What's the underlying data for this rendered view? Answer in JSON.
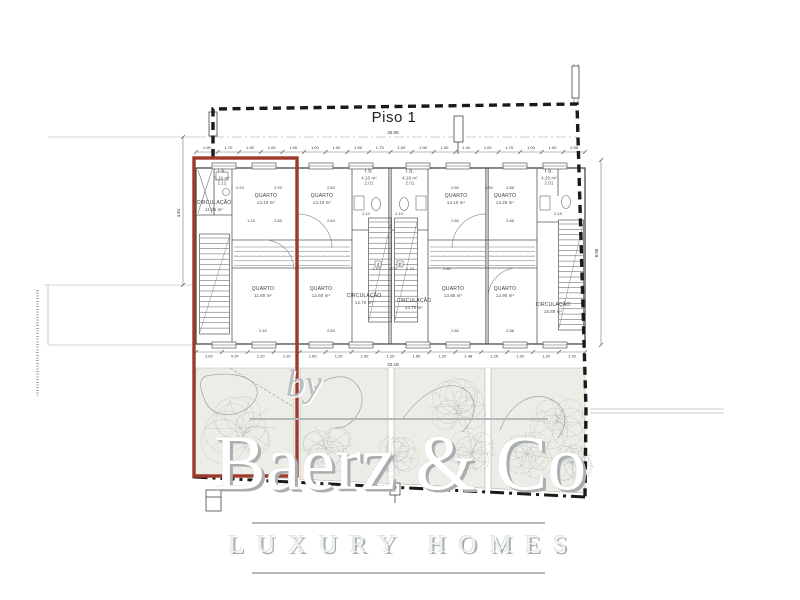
{
  "title": "Piso 1",
  "watermark": {
    "prefix": "by",
    "brand": "Baerz & Co",
    "tagline": "LUXURY HOMES"
  },
  "colors": {
    "highlight_red": "#9e3a2b",
    "boundary_black": "#1a1a1a",
    "plan_line": "#555555",
    "garden_fill": "#ecede6",
    "tree_gray": "#8f9797",
    "watermark_gray": "#b3b8b8"
  },
  "rooms": [
    {
      "label": "I.S.",
      "area": "3.10 m²",
      "sub": "2.12",
      "x": 222,
      "y": 177
    },
    {
      "label": "CIRCULAÇÃO",
      "area": "11.05 m²",
      "x": 214,
      "y": 206
    },
    {
      "label": "QUARTO",
      "area": "13.10 m²",
      "x": 266,
      "y": 199
    },
    {
      "label": "QUARTO",
      "area": "11.80 m²",
      "x": 263,
      "y": 292
    },
    {
      "label": "QUARTO",
      "area": "13.10 m²",
      "x": 322,
      "y": 199
    },
    {
      "label": "I.S.",
      "area": "4.20 m²",
      "sub": "2.01",
      "x": 369,
      "y": 177
    },
    {
      "label": "QUARTO",
      "area": "12.60 m²",
      "x": 321,
      "y": 292
    },
    {
      "label": "CIRCULAÇÃO",
      "area": "14.70 m²",
      "x": 364,
      "y": 299
    },
    {
      "label": "I.S.",
      "area": "4.20 m²",
      "sub": "2.01",
      "x": 410,
      "y": 177
    },
    {
      "label": "QUARTO",
      "area": "13.10 m²",
      "x": 456,
      "y": 199
    },
    {
      "label": "CIRCULAÇÃO",
      "area": "14.70 m²",
      "x": 414,
      "y": 304
    },
    {
      "label": "QUARTO",
      "area": "13.85 m²",
      "x": 453,
      "y": 292
    },
    {
      "label": "QUARTO",
      "area": "13.25 m²",
      "x": 505,
      "y": 199
    },
    {
      "label": "I.S.",
      "area": "4.20 m²",
      "sub": "2.01",
      "x": 549,
      "y": 177
    },
    {
      "label": "QUARTO",
      "area": "12.95 m²",
      "x": 505,
      "y": 292
    },
    {
      "label": "CIRCULAÇÃO",
      "area": "15.80 m²",
      "x": 553,
      "y": 308
    }
  ],
  "plan_dims": [
    {
      "t": "2.93",
      "x": 278,
      "y": 189
    },
    {
      "t": "2.83",
      "x": 278,
      "y": 222
    },
    {
      "t": "0.24",
      "x": 240,
      "y": 189
    },
    {
      "t": "1.15",
      "x": 251,
      "y": 222
    },
    {
      "t": "2.84",
      "x": 331,
      "y": 189
    },
    {
      "t": "2.84",
      "x": 331,
      "y": 222
    },
    {
      "t": "2.10",
      "x": 366,
      "y": 215
    },
    {
      "t": "2.10",
      "x": 399,
      "y": 215
    },
    {
      "t": "2.80",
      "x": 455,
      "y": 189
    },
    {
      "t": "2.80",
      "x": 455,
      "y": 222
    },
    {
      "t": "2.86",
      "x": 510,
      "y": 189
    },
    {
      "t": "2.86",
      "x": 510,
      "y": 222
    },
    {
      "t": "2.40",
      "x": 263,
      "y": 332
    },
    {
      "t": "2.84",
      "x": 331,
      "y": 332
    },
    {
      "t": "2.80",
      "x": 455,
      "y": 332
    },
    {
      "t": "2.86",
      "x": 510,
      "y": 332
    },
    {
      "t": "1.10",
      "x": 376,
      "y": 270
    },
    {
      "t": "1.00",
      "x": 393,
      "y": 270
    },
    {
      "t": "1.10",
      "x": 410,
      "y": 270
    },
    {
      "t": "2.80",
      "x": 447,
      "y": 270
    },
    {
      "t": "2.19",
      "x": 558,
      "y": 215
    },
    {
      "t": "0.30",
      "x": 489,
      "y": 189
    }
  ],
  "section_markers": [
    {
      "t": "4",
      "x": 378,
      "y": 266
    },
    {
      "t": "E",
      "x": 400,
      "y": 266
    }
  ],
  "dims": {
    "overall_top": "25.08",
    "overall_bottom": "22.18",
    "left": "4.81",
    "right": "8.05",
    "top_row": [
      "1.00",
      "1.70",
      "1.00",
      "1.00",
      "1.00",
      "1.00",
      "1.00",
      "1.00",
      "1.73",
      "1.00",
      "1.00",
      "1.00",
      "1.44",
      "1.00",
      "1.70",
      "1.00",
      "1.00",
      "0.96"
    ],
    "bottom_row": [
      "2.62",
      "0.97",
      "1.20",
      "1.20",
      "1.60",
      "1.20",
      "1.92",
      "1.20",
      "1.60",
      "1.20",
      "1.48",
      "1.20",
      "1.92",
      "1.20",
      "1.20"
    ]
  }
}
